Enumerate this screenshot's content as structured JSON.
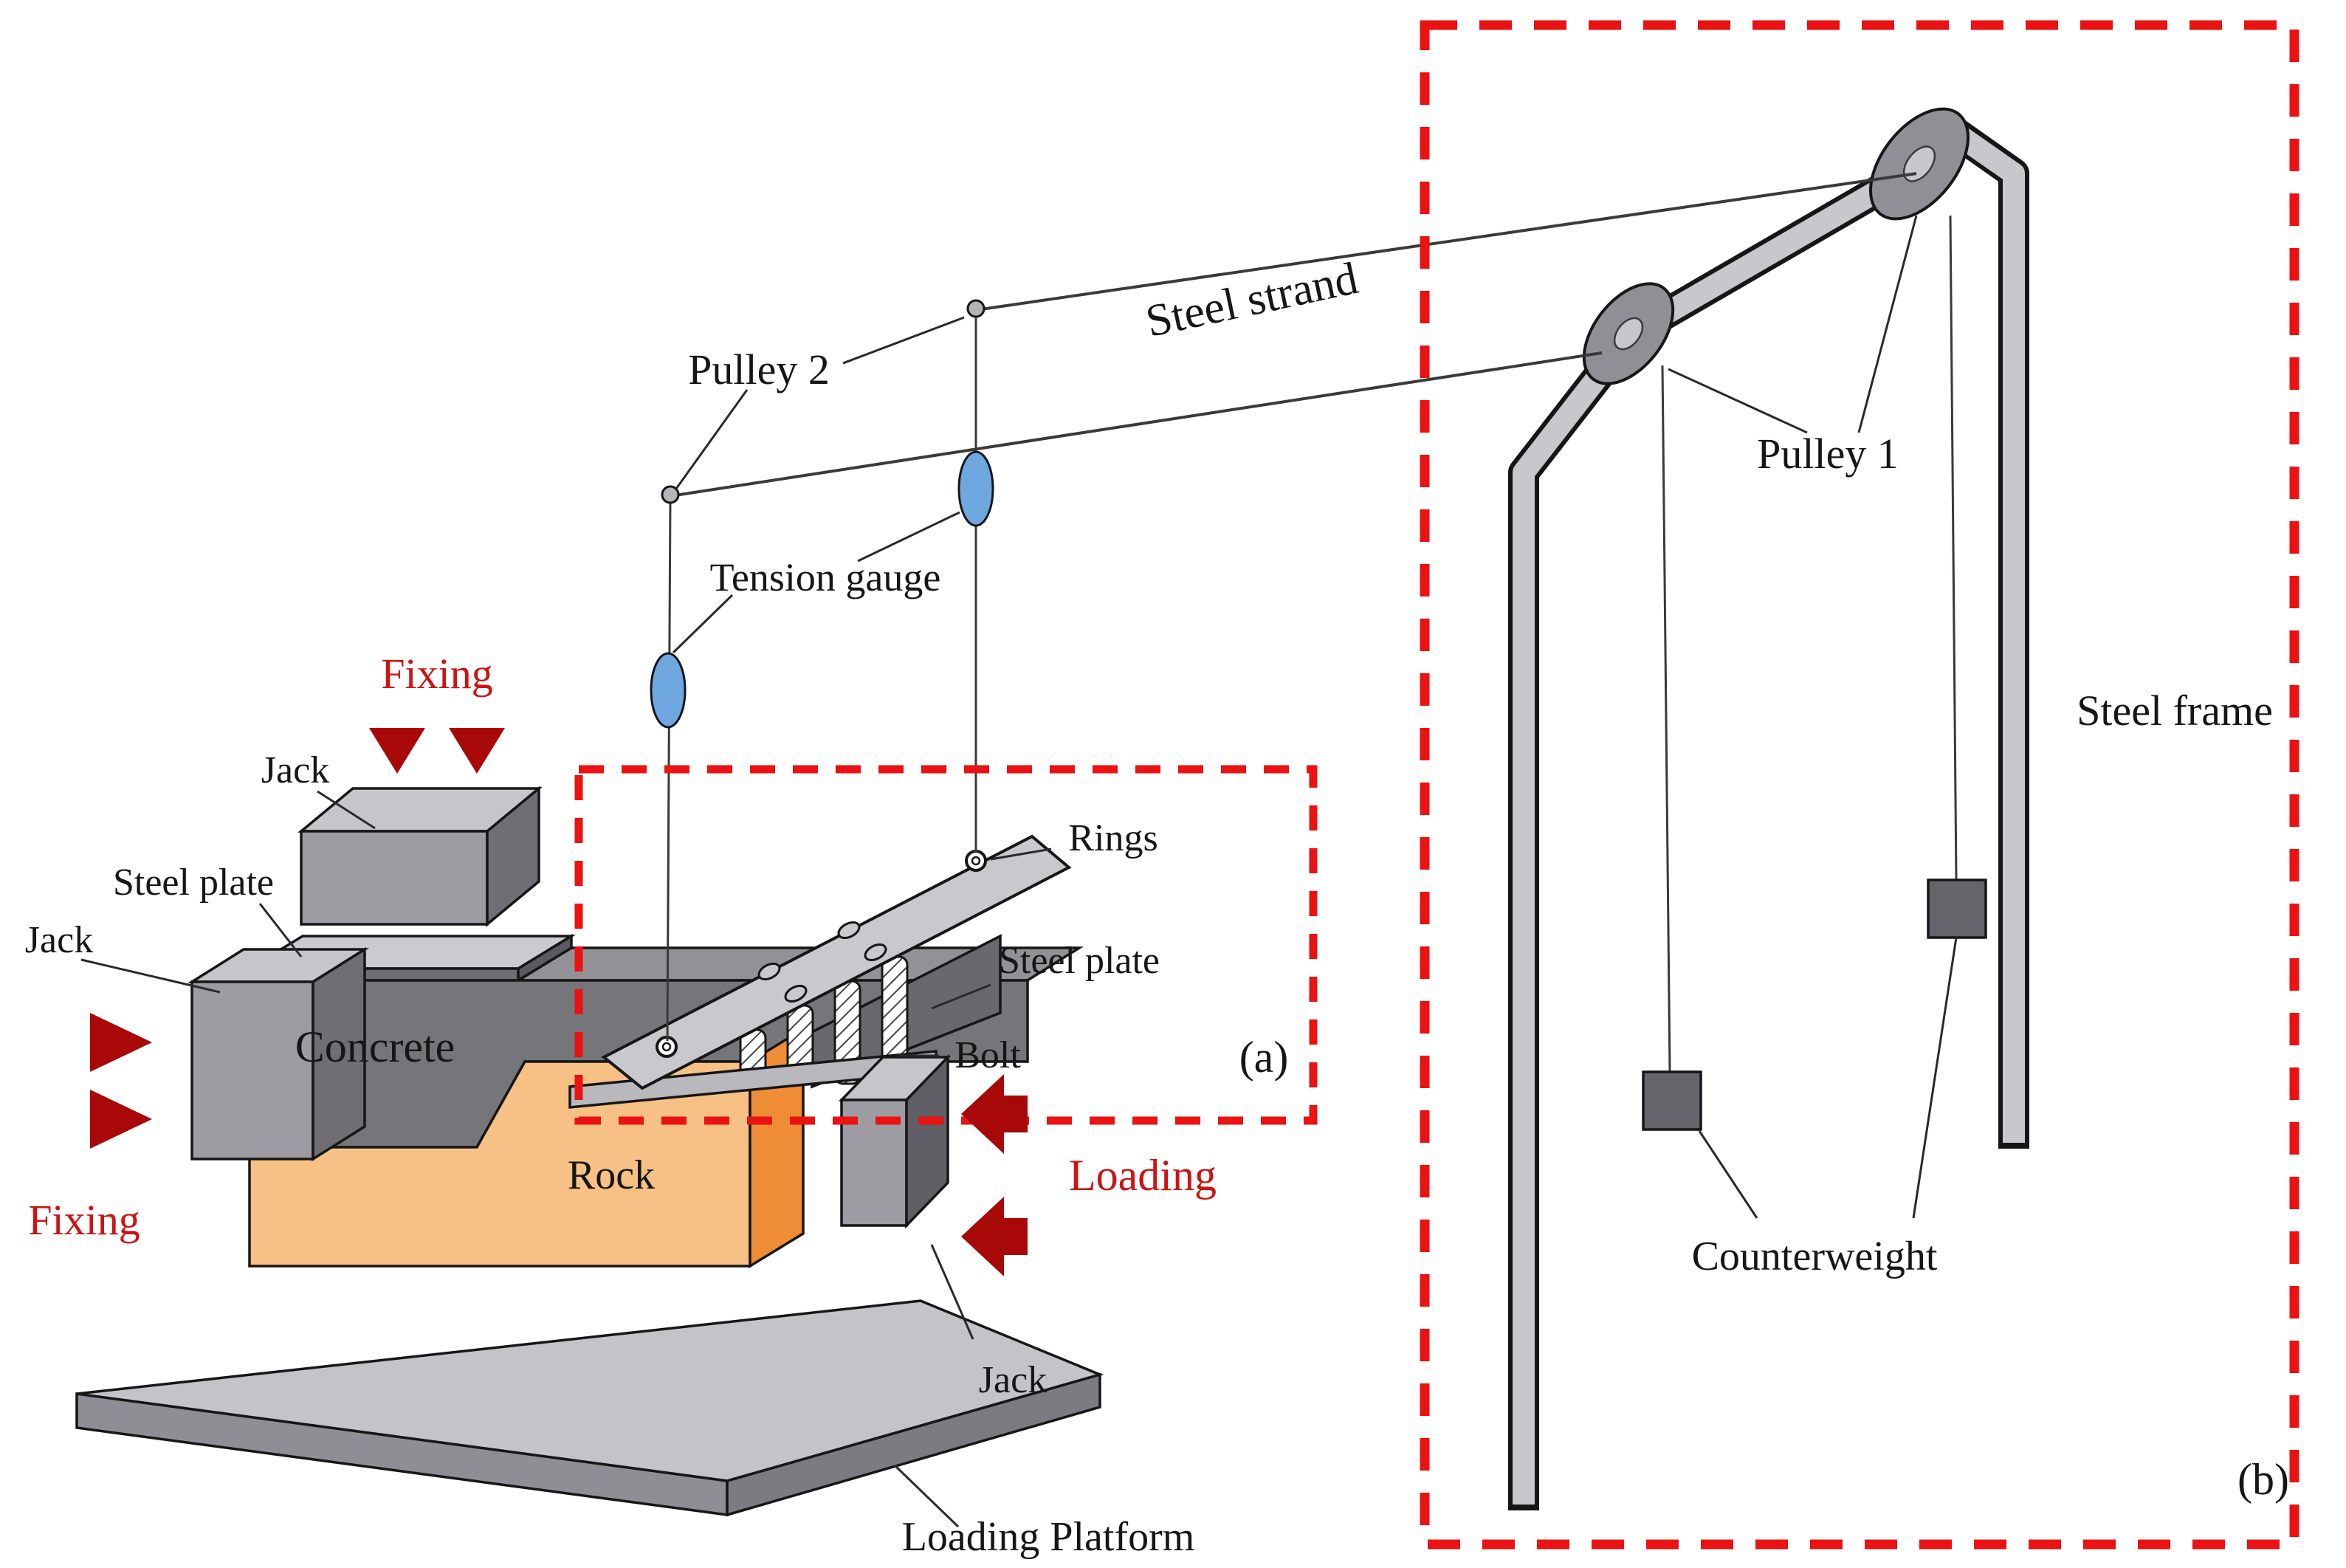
{
  "labels": {
    "pulley2": "Pulley 2",
    "steel_strand": "Steel strand",
    "tension_gauge": "Tension gauge",
    "pulley1": "Pulley 1",
    "steel_frame": "Steel frame",
    "counterweight": "Counterweight",
    "rings": "Rings",
    "steel_plate_top": "Steel plate",
    "steel_plate_inner": "Steel plate",
    "bolt": "Bolt",
    "jack_top": "Jack",
    "jack_left": "Jack",
    "jack_right": "Jack",
    "concrete": "Concrete",
    "rock": "Rock",
    "fixing_top": "Fixing",
    "fixing_left": "Fixing",
    "loading": "Loading",
    "loading_platform": "Loading Platform"
  },
  "panels": {
    "a": "(a)",
    "b": "(b)"
  },
  "colors": {
    "red_dashed_box": "#ea1212",
    "red_text": "#cc1414",
    "dark_red_arrow": "#a80808",
    "rock_front": "#f7c186",
    "rock_side": "#ee8d35",
    "concrete_front": "#76767a",
    "concrete_top": "#929296",
    "steel_light": "#c9c9cd",
    "steel_mid": "#9c9ca2",
    "steel_dark": "#6e6e74",
    "gauge_blue": "#6fa8e0"
  }
}
